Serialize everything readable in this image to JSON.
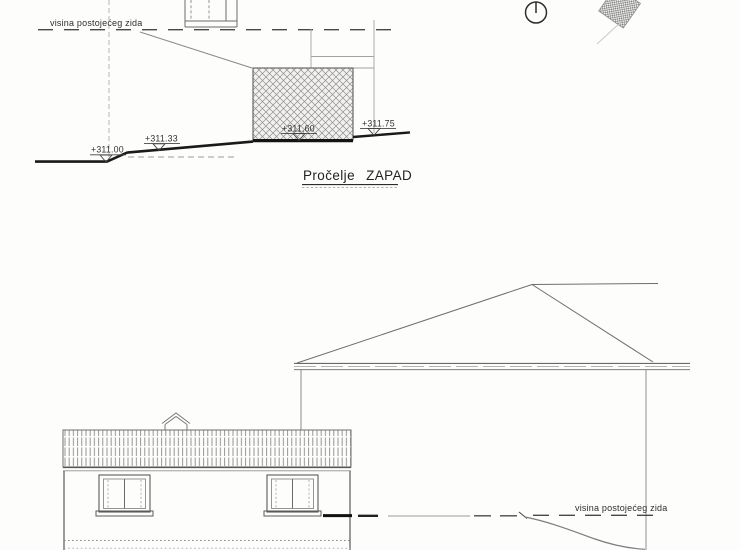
{
  "west_elevation": {
    "title": "Pročelje ZAPAD",
    "existing_wall_label": "visina postojećeg zida",
    "levels": [
      {
        "label": "+311.00"
      },
      {
        "label": "+311.33"
      },
      {
        "label": "+311,60"
      },
      {
        "label": "+311.75"
      }
    ]
  },
  "east_elevation": {
    "existing_wall_label": "visina postojećeg zida"
  },
  "symbols": {
    "north_icon": "north-orientation-circle",
    "site_marker_icon": "hatched-site-marker"
  },
  "colors": {
    "paper": "#fdfdfc",
    "ink": "#3a3a3a",
    "heavy_ink": "#141414",
    "light_ink": "#9a9a9a"
  }
}
